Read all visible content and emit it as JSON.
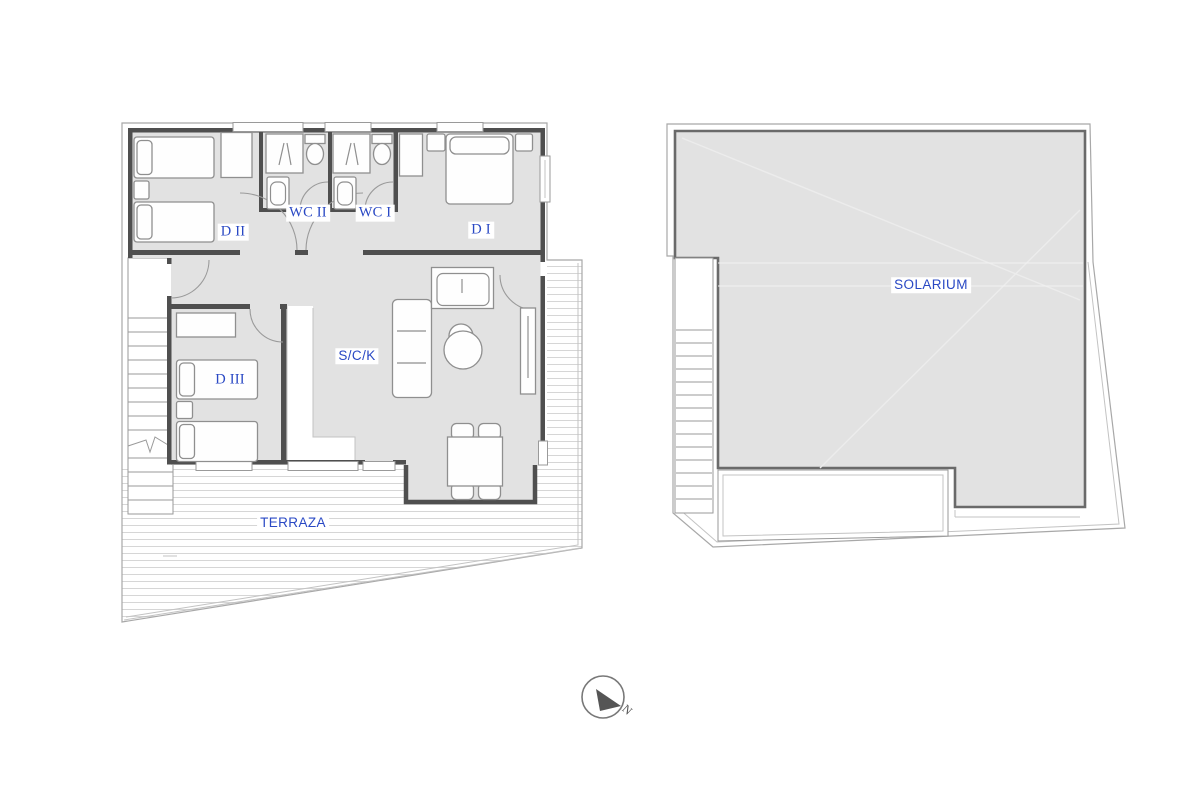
{
  "left_plan": {
    "labels": {
      "d2": "D II",
      "wc2": "WC II",
      "wc1": "WC I",
      "d1": "D I",
      "d3": "D III",
      "sck": "S/C/K",
      "terraza": "TERRAZA"
    }
  },
  "right_plan": {
    "labels": {
      "solarium": "SOLARIUM"
    }
  },
  "compass": {
    "north_label": "N"
  },
  "colors": {
    "label_blue": "#2948c4",
    "wall_gray": "#4f4f4f",
    "room_fill": "#e2e2e2",
    "boundary_gray": "#a8a8a8",
    "deck_stripe": "#d6d6d6",
    "compass_dark": "#555555",
    "background": "#ffffff"
  }
}
